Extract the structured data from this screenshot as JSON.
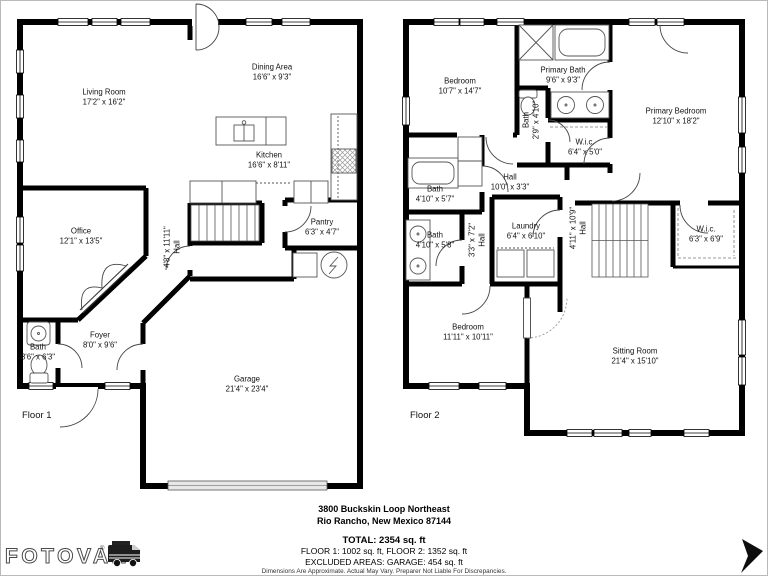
{
  "floors": [
    {
      "name": "Floor 1",
      "rooms": [
        {
          "name": "Living Room",
          "dims": "17'2\" x 16'2\""
        },
        {
          "name": "Dining Area",
          "dims": "16'6\" x 9'3\""
        },
        {
          "name": "Kitchen",
          "dims": "16'6\" x 8'11\""
        },
        {
          "name": "Office",
          "dims": "12'1\" x 13'5\""
        },
        {
          "name": "Pantry",
          "dims": "6'3\" x 4'7\""
        },
        {
          "name": "Hall",
          "dims": "4'8\" x 11'11\""
        },
        {
          "name": "Bath",
          "dims": "3'6\" x 6'3\""
        },
        {
          "name": "Foyer",
          "dims": "8'0\" x 9'6\""
        },
        {
          "name": "Garage",
          "dims": "21'4\" x 23'4\""
        }
      ]
    },
    {
      "name": "Floor 2",
      "rooms": [
        {
          "name": "Bedroom",
          "dims": "10'7\" x 14'7\""
        },
        {
          "name": "Primary Bath",
          "dims": "9'6\" x 9'3\""
        },
        {
          "name": "Primary Bedroom",
          "dims": "12'10\" x 18'2\""
        },
        {
          "name": "Bath",
          "dims": "2'9\" x 4'10\""
        },
        {
          "name": "W.i.c.",
          "dims": "6'4\" x 5'0\""
        },
        {
          "name": "Hall",
          "dims": "10'0\" x 3'3\""
        },
        {
          "name": "Bath",
          "dims": "4'10\" x 5'7\""
        },
        {
          "name": "Bath",
          "dims": "4'10\" x 5'8\""
        },
        {
          "name": "Hall",
          "dims": "3'3\" x 7'2\""
        },
        {
          "name": "Laundry",
          "dims": "6'4\" x 6'10\""
        },
        {
          "name": "Hall",
          "dims": "4'11\" x 10'9\""
        },
        {
          "name": "W.i.c.",
          "dims": "6'3\" x 6'9\""
        },
        {
          "name": "Bedroom",
          "dims": "11'11\" x 10'11\""
        },
        {
          "name": "Sitting Room",
          "dims": "21'4\" x 15'10\""
        }
      ]
    }
  ],
  "address": {
    "line1": "3800 Buckskin Loop Northeast",
    "line2": "Rio Rancho, New Mexico 87144"
  },
  "summary": {
    "total": "TOTAL: 2354 sq. ft",
    "floors": "FLOOR 1: 1002 sq. ft, FLOOR 2: 1352 sq. ft",
    "excluded": "EXCLUDED AREAS: GARAGE: 454 sq. ft"
  },
  "disclaimer": "Dimensions Are Approximate. Actual May Vary. Preparer Not Liable For Discrepancies.",
  "brand": {
    "name": "FOTOVAN",
    "mark": "®"
  }
}
